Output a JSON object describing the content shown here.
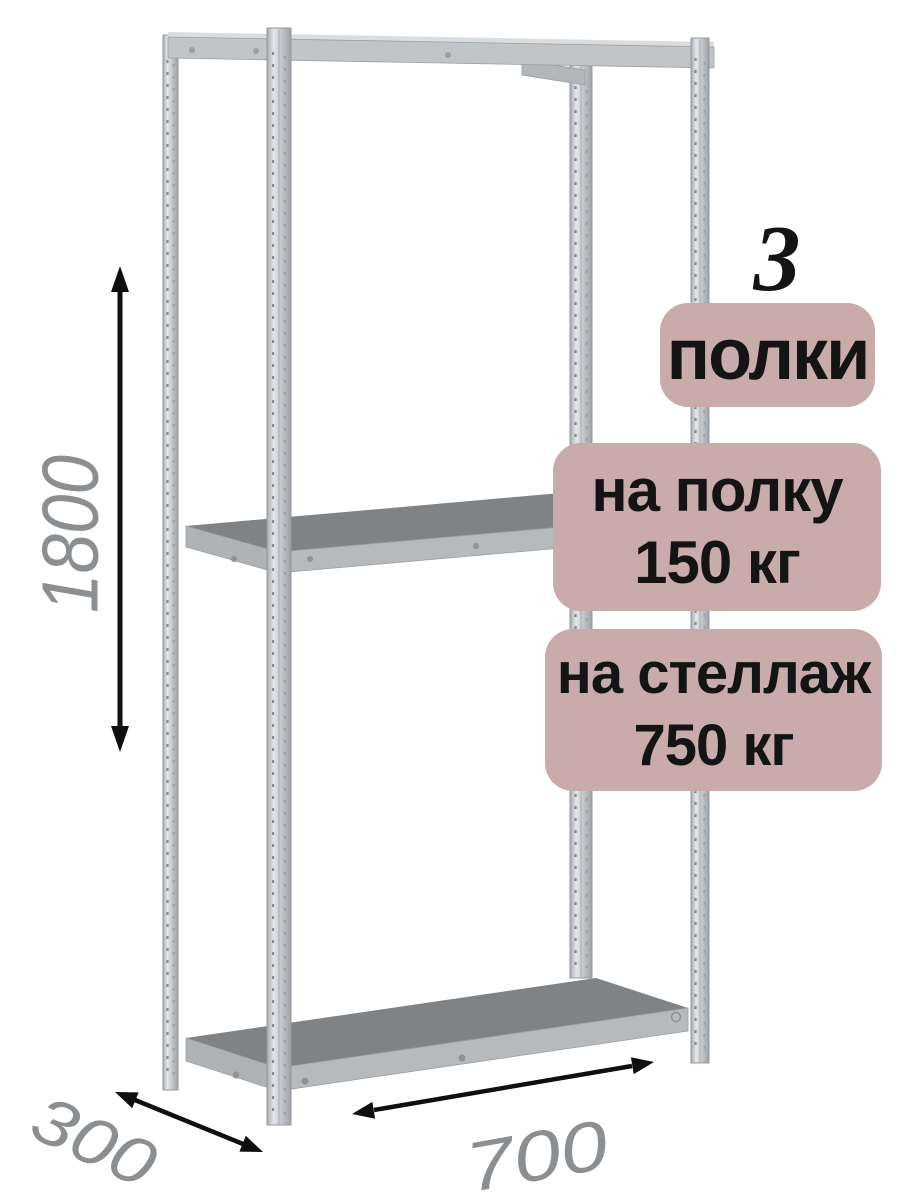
{
  "diagram": {
    "subject": "металлический стеллаж",
    "dimensions": {
      "height": "1800",
      "depth": "300",
      "width": "700"
    },
    "badges": {
      "count_number": "3",
      "count_label": "полки",
      "shelf_load_title": "на полку",
      "shelf_load_value": "150 кг",
      "rack_load_title": "на стеллаж",
      "rack_load_value": "750 кг"
    },
    "colors": {
      "badge_background": "#c9abab",
      "badge_text": "#141414",
      "dimension_text": "#8b8f92",
      "arrow": "#0f0f0f",
      "metal_light": "#cfd2d5",
      "metal_mid": "#b7babd",
      "shelf_top_surface": "#7f8386",
      "background": "#ffffff"
    }
  }
}
